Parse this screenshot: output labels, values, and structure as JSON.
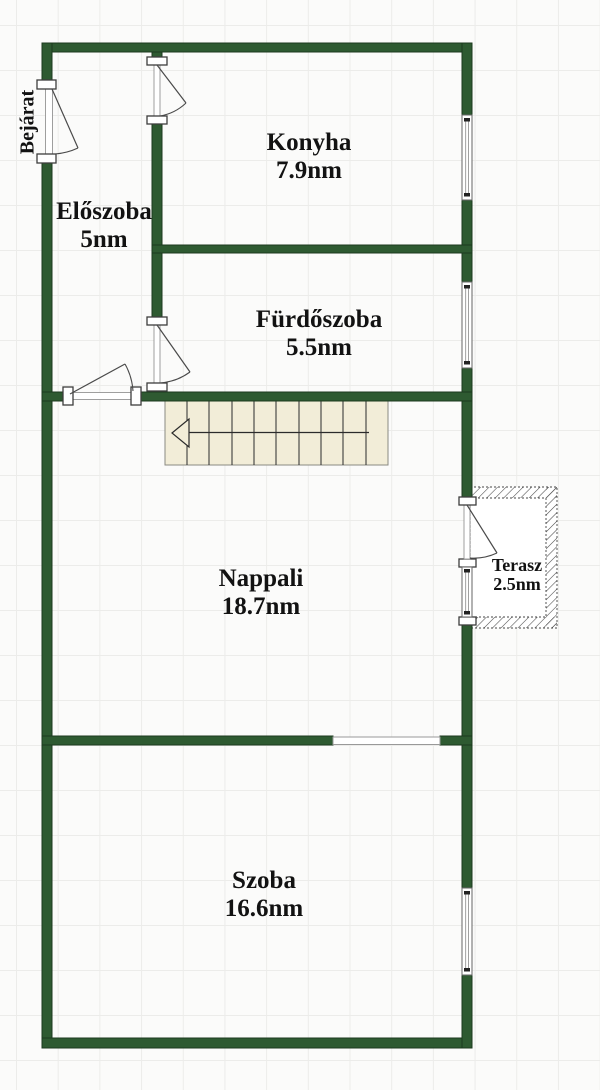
{
  "floor_plan": {
    "entrance_label": "Bejárat",
    "rooms": [
      {
        "id": "eloszoba",
        "name": "Előszoba",
        "area": "5nm"
      },
      {
        "id": "konyha",
        "name": "Konyha",
        "area": "7.9nm"
      },
      {
        "id": "furdoszoba",
        "name": "Fürdőszoba",
        "area": "5.5nm"
      },
      {
        "id": "nappali",
        "name": "Nappali",
        "area": "18.7nm"
      },
      {
        "id": "terasz",
        "name": "Terasz",
        "area": "2.5nm"
      },
      {
        "id": "szoba",
        "name": "Szoba",
        "area": "16.6nm"
      }
    ],
    "colors": {
      "wall": "#2e5a31",
      "wall_outline": "#1c3a1e",
      "stairs_fill": "#f2edd8",
      "grid_line": "#ececea",
      "background": "#fbfbfa",
      "symbol_line": "#4a4a4a"
    },
    "symbols": {
      "stairs_steps": 10,
      "stairs_direction": "left",
      "door_count": 5,
      "window_count": 4
    }
  }
}
